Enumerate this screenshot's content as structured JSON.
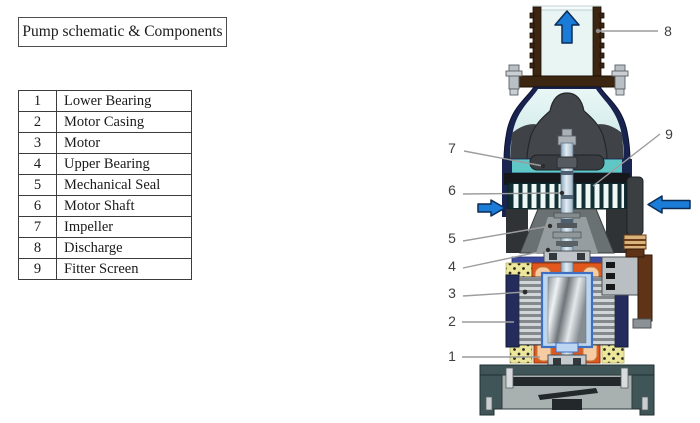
{
  "title_box": {
    "label": "Pump schematic & Components"
  },
  "components_table": {
    "rows": [
      {
        "num": "1",
        "name": "Lower Bearing"
      },
      {
        "num": "2",
        "name": "Motor Casing"
      },
      {
        "num": "3",
        "name": "Motor"
      },
      {
        "num": "4",
        "name": "Upper Bearing"
      },
      {
        "num": "5",
        "name": "Mechanical Seal"
      },
      {
        "num": "6",
        "name": "Motor Shaft"
      },
      {
        "num": "7",
        "name": "Impeller"
      },
      {
        "num": "8",
        "name": "Discharge"
      },
      {
        "num": "9",
        "name": "Fitter Screen"
      }
    ]
  },
  "diagram": {
    "labels": {
      "l1": "1",
      "l2": "2",
      "l3": "3",
      "l4": "4",
      "l5": "5",
      "l6": "6",
      "l7": "7",
      "l8": "8",
      "l9": "9"
    },
    "colors": {
      "flow_arrow_blue": "#1a7cd6",
      "leader_gray": "#9c9c9c",
      "casing_navy": "#1a2550",
      "volute_teal": "#5fc8c6",
      "pipe_brown": "#3c2511",
      "water_light_cyan": "#e8f5f2",
      "winding_orange": "#e2571c",
      "winding_peach": "#f6cba2",
      "insulation_yellow": "#ece79b",
      "impeller_charcoal": "#43474b"
    }
  }
}
